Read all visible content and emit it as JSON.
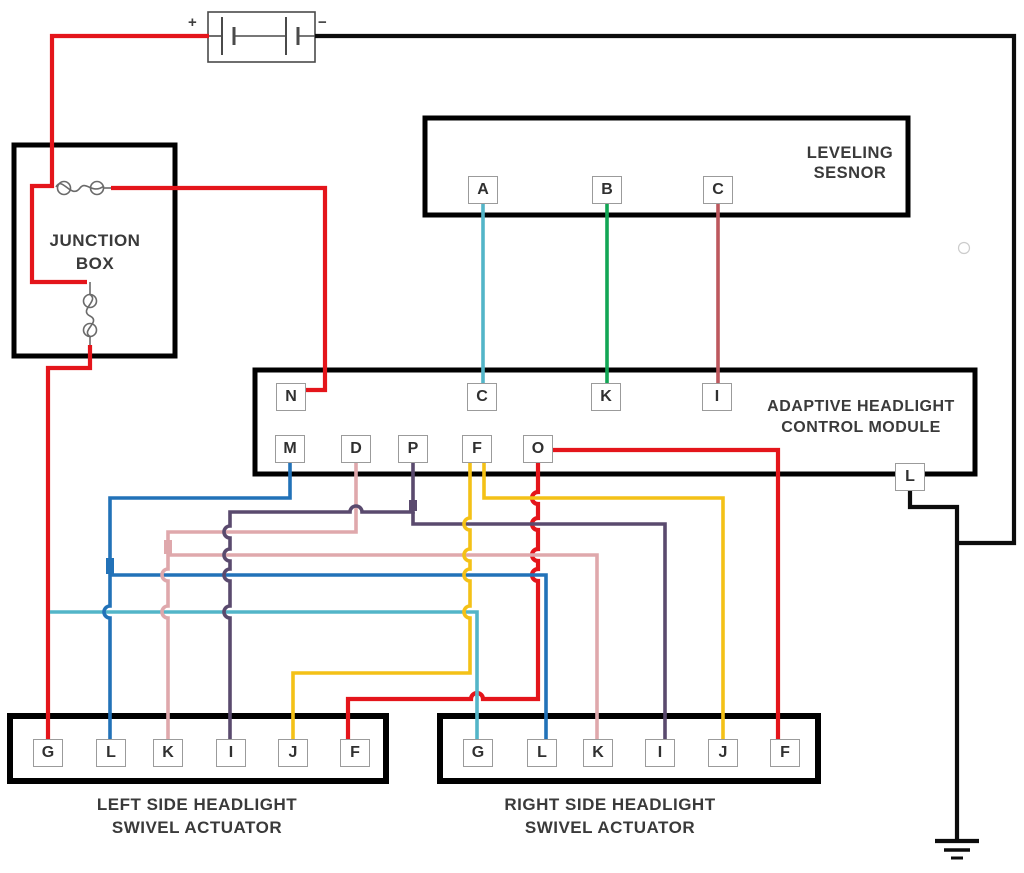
{
  "diagram_title": "Adaptive headlight wiring diagram",
  "colors": {
    "red": "#e4151b",
    "black": "#0c0c0c",
    "blue": "#2272b8",
    "teal": "#53b5c8",
    "green": "#12a655",
    "rose": "#bd585e",
    "pink": "#dfa8ac",
    "purple": "#5a4a6e",
    "yellow": "#f4c117",
    "box_border": "#000000",
    "battery_outline": "#4a4a4a",
    "fuse_outline": "#6a6a6a"
  },
  "battery": {
    "positive": "+",
    "negative": "−"
  },
  "junction_box": {
    "line1": "JUNCTION",
    "line2": "BOX"
  },
  "leveling_sensor": {
    "line1": "LEVELING",
    "line2": "SESNOR",
    "terminals": [
      {
        "label": "A"
      },
      {
        "label": "B"
      },
      {
        "label": "C"
      }
    ]
  },
  "control_module": {
    "line1": "ADAPTIVE HEADLIGHT",
    "line2": "CONTROL MODULE",
    "top_terminals": [
      {
        "label": "N"
      },
      {
        "label": "C"
      },
      {
        "label": "K"
      },
      {
        "label": "I"
      }
    ],
    "bottom_terminals": [
      {
        "label": "M"
      },
      {
        "label": "D"
      },
      {
        "label": "P"
      },
      {
        "label": "F"
      },
      {
        "label": "O"
      }
    ],
    "side_terminal": {
      "label": "L"
    }
  },
  "left_actuator": {
    "line1": "LEFT SIDE HEADLIGHT",
    "line2": "SWIVEL ACTUATOR",
    "terminals": [
      {
        "label": "G"
      },
      {
        "label": "L"
      },
      {
        "label": "K"
      },
      {
        "label": "I"
      },
      {
        "label": "J"
      },
      {
        "label": "F"
      }
    ]
  },
  "right_actuator": {
    "line1": "RIGHT SIDE HEADLIGHT",
    "line2": "SWIVEL ACTUATOR",
    "terminals": [
      {
        "label": "G"
      },
      {
        "label": "L"
      },
      {
        "label": "K"
      },
      {
        "label": "I"
      },
      {
        "label": "J"
      },
      {
        "label": "F"
      }
    ]
  }
}
